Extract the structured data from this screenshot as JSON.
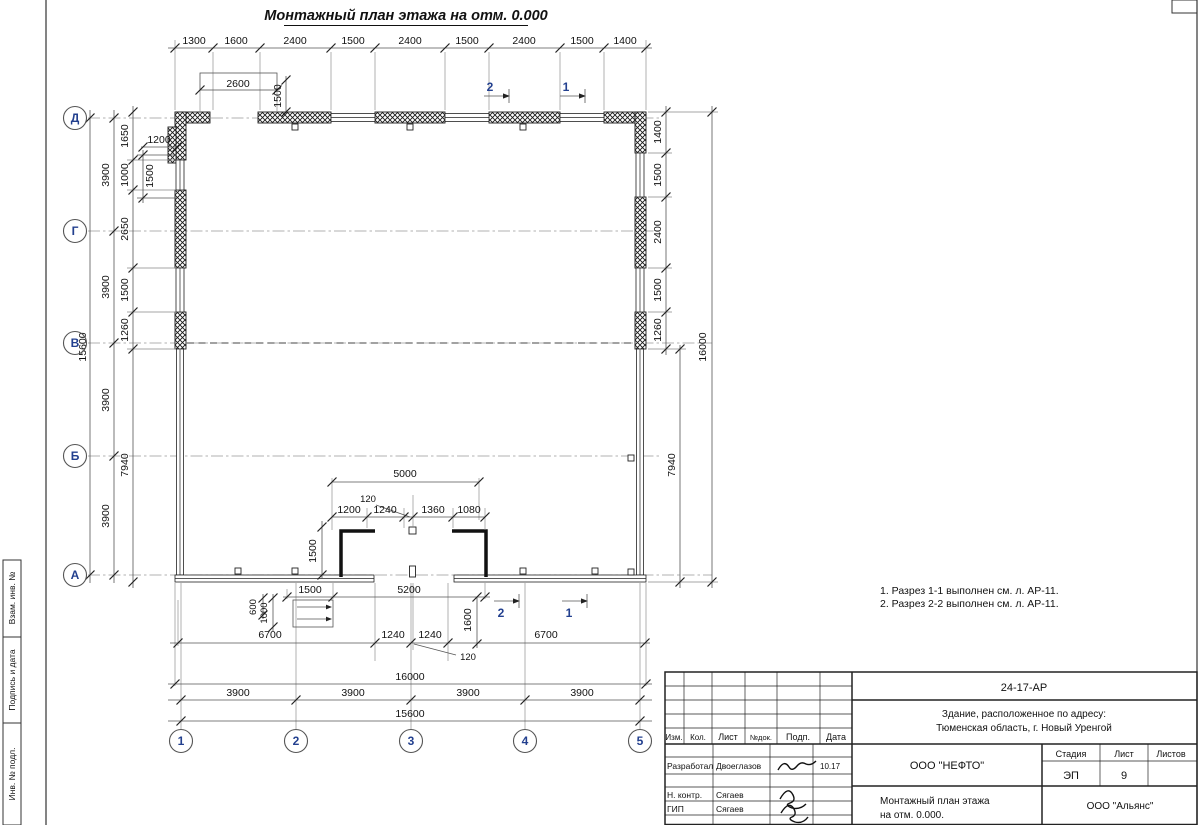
{
  "drawing_title": "Монтажный план этажа на отм. 0.000",
  "notes": [
    "1. Разрез 1-1 выполнен см. л. АР-11.",
    "2. Разрез 2-2 выполнен см. л. АР-11."
  ],
  "axes": {
    "rows": [
      "Д",
      "Г",
      "В",
      "Б",
      "А"
    ],
    "cols": [
      "1",
      "2",
      "3",
      "4",
      "5"
    ]
  },
  "sections": {
    "top_2": "2",
    "top_1": "1",
    "bottom_2": "2",
    "bottom_1": "1"
  },
  "dims": {
    "top_chain": [
      "1300",
      "1600",
      "2400",
      "1500",
      "2400",
      "1500",
      "2400",
      "1500",
      "1400"
    ],
    "top_opening": "2600",
    "top_opening_h": "1500",
    "left_total": "15600",
    "left_axis": [
      "3900",
      "3900",
      "3900",
      "3900"
    ],
    "left_chain": [
      "1650",
      "1000",
      "2650",
      "1500",
      "1260",
      "7940"
    ],
    "left_win_w": "1200",
    "left_win_h": "1500",
    "right_chain": [
      "1400",
      "1500",
      "2400",
      "1500",
      "1260"
    ],
    "right_lower": "7940",
    "right_total": "16000",
    "vest_total": "5000",
    "vest_gap": "120",
    "vest_chain": [
      "1200",
      "1240",
      "1360",
      "1080"
    ],
    "vest_depth": "1500",
    "porch_w": "1500",
    "porch_span": "5200",
    "porch_d1": "600",
    "porch_d2": "1000",
    "porch_d3": "1600",
    "bottom_chain": [
      "6700",
      "1240",
      "1240",
      "6700"
    ],
    "bottom_gap": "120",
    "bottom_total": "16000",
    "bottom_axis": [
      "3900",
      "3900",
      "3900",
      "3900"
    ],
    "bottom_axis_total": "15600"
  },
  "frame_labels": [
    "Взам. инв. №",
    "Подпись и дата",
    "Инв. № подл."
  ],
  "title_block": {
    "doc_number": "24-17-АР",
    "object_line1": "Здание, расположенное по адресу:",
    "object_line2": "Тюменская область, г. Новый Уренгой",
    "cols": [
      "Изм.",
      "Кол.",
      "Лист",
      "№док.",
      "Подп.",
      "Дата"
    ],
    "rows": [
      {
        "role": "Разработал",
        "name": "Двоеглазов",
        "date": "10.17"
      },
      {
        "role": "Н. контр.",
        "name": "Сягаев",
        "date": ""
      },
      {
        "role": "ГИП",
        "name": "Сягаев",
        "date": ""
      }
    ],
    "company": "ООО \"НЕФТО\"",
    "stage_cols": [
      "Стадия",
      "Лист",
      "Листов"
    ],
    "stage": "ЭП",
    "sheet": "9",
    "total_sheets": "",
    "subject_line1": "Монтажный план этажа",
    "subject_line2": "на отм. 0.000.",
    "org": "ООО \"Альянс\"",
    "accent_blue": "#23408f"
  }
}
